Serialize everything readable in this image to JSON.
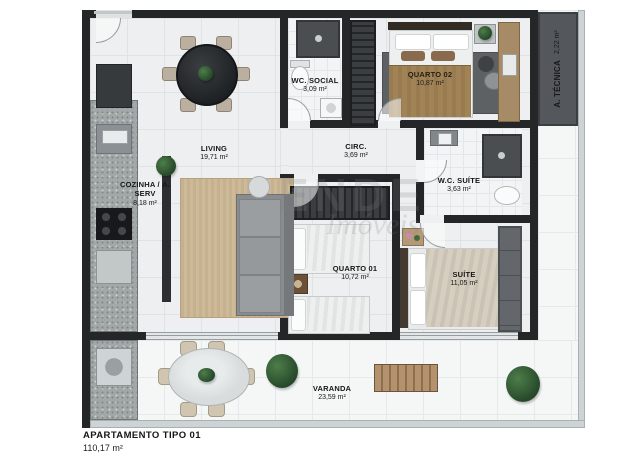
{
  "footer": {
    "title": "APARTAMENTO TIPO 01",
    "area": "110,17 m²"
  },
  "watermark": {
    "line1": "ENDE",
    "line2": "Imóveis"
  },
  "rooms": {
    "living": {
      "label": "LIVING",
      "area": "19,71 m²"
    },
    "cozinha": {
      "label": "COZINHA / Á. SERV",
      "area": "8,18 m²"
    },
    "wc_social": {
      "label": "WC. SOCIAL",
      "area": "3,09 m²"
    },
    "quarto02": {
      "label": "QUARTO 02",
      "area": "10,87 m²"
    },
    "a_tecnica": {
      "label": "A. TÉCNICA",
      "area": "2,22 m²"
    },
    "circ": {
      "label": "CIRC.",
      "area": "3,69 m²"
    },
    "wc_suite": {
      "label": "W.C. SUÍTE",
      "area": "3,63 m²"
    },
    "quarto01": {
      "label": "QUARTO 01",
      "area": "10,72 m²"
    },
    "suite": {
      "label": "SUÍTE",
      "area": "11,05 m²"
    },
    "varanda": {
      "label": "VARANDA",
      "area": "23,59 m²"
    }
  },
  "colors": {
    "wall": "#242628",
    "floor_tile": "#edeff0",
    "varanda_tile": "#f5f7f7",
    "granite": "#a2a7a7",
    "wood": "#a78b67",
    "rug_beige": "#cfba97",
    "rug_dark": "#5d6164",
    "technical_area": "#54585c",
    "plant_green": "#2e5c35",
    "label_text": "#171717"
  }
}
